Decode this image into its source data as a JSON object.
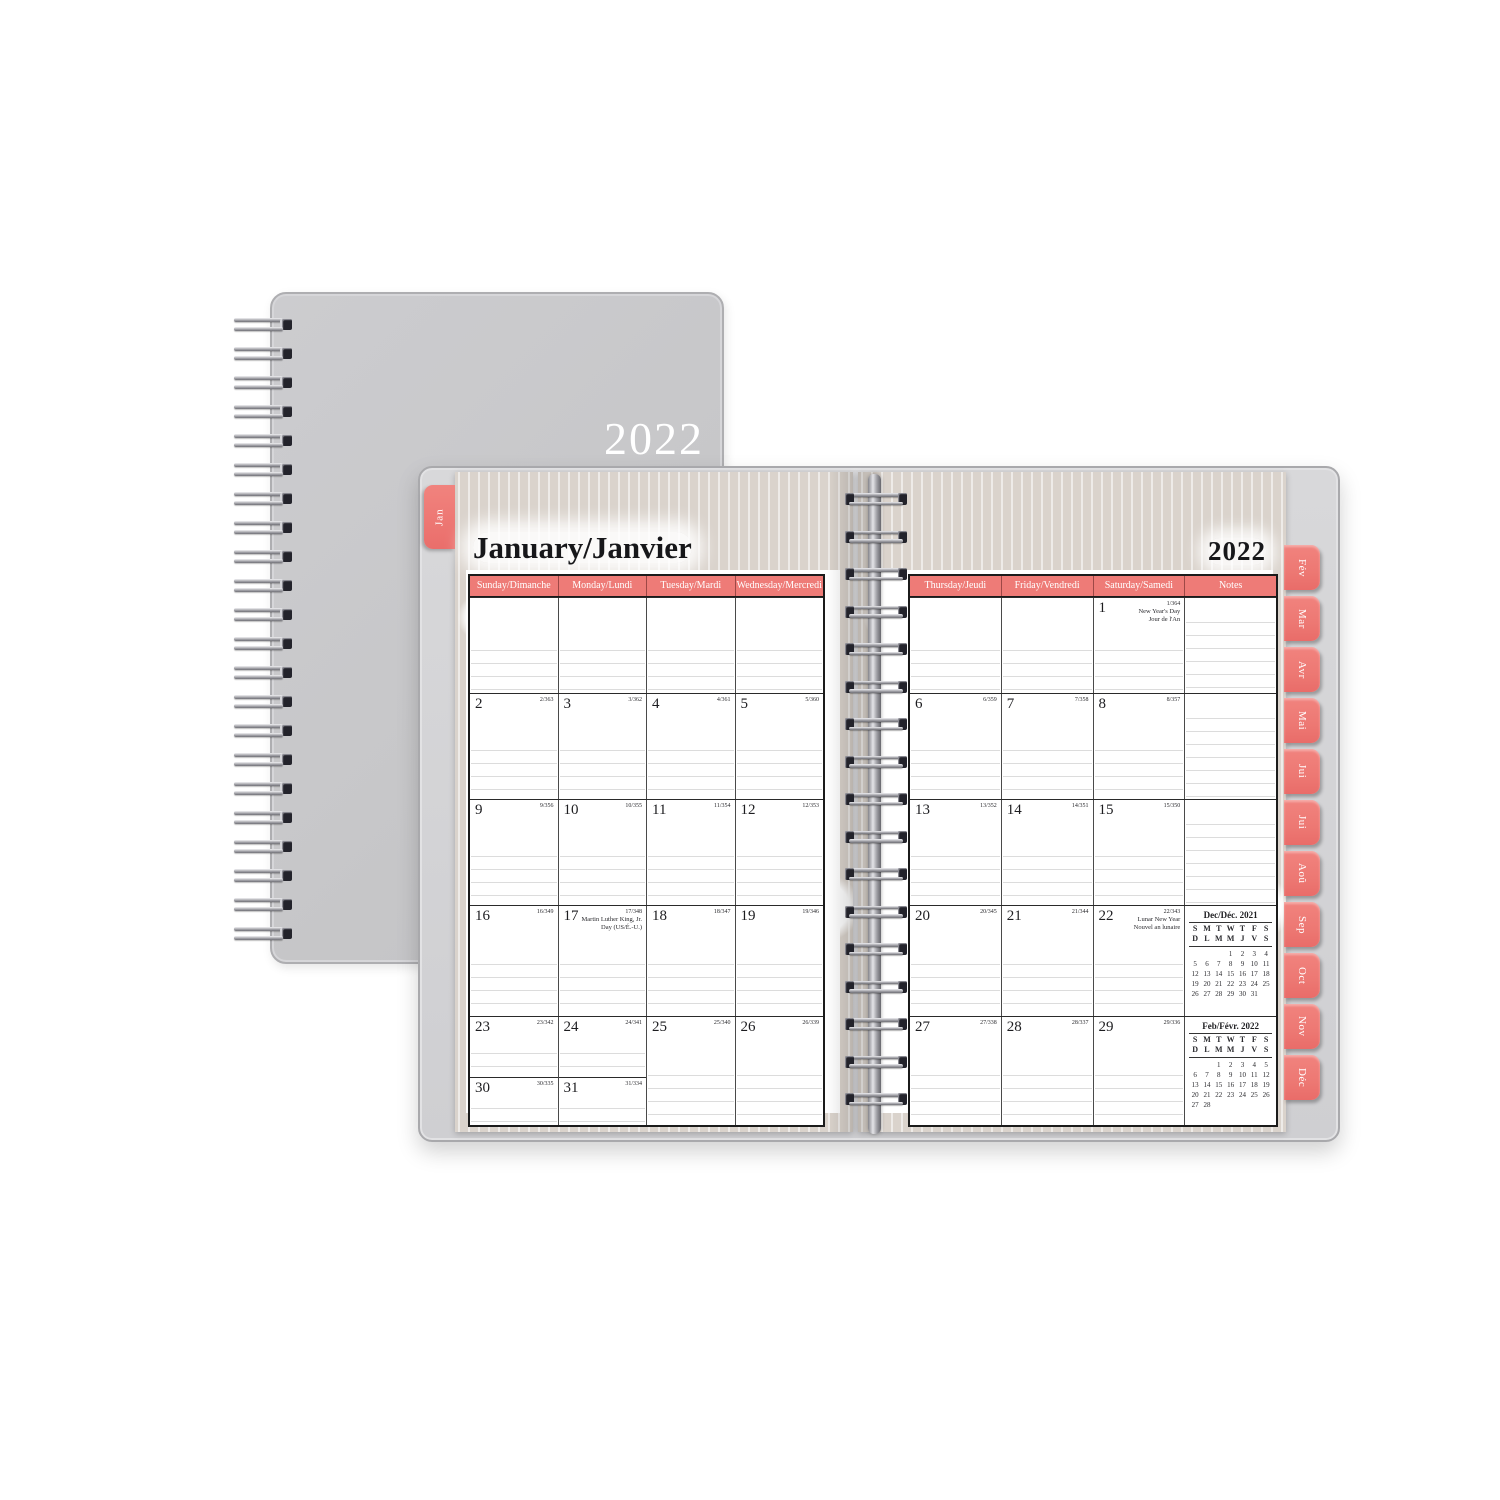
{
  "cover": {
    "year": "2022"
  },
  "planner": {
    "left_page": {
      "tab": "Jan",
      "title": "January/Janvier",
      "day_headers": [
        "Sunday/Dimanche",
        "Monday/Lundi",
        "Tuesday/Mardi",
        "Wednesday/Mercredi"
      ]
    },
    "right_page": {
      "year": "2022",
      "day_headers": [
        "Thursday/Jeudi",
        "Friday/Vendredi",
        "Saturday/Samedi",
        "Notes"
      ]
    },
    "month_tabs": [
      "Fév",
      "Mar",
      "Avr",
      "Mai",
      "Jui",
      "Jui",
      "Aoû",
      "Sep",
      "Oct",
      "Nov",
      "Déc"
    ],
    "colors": {
      "coral": "#ee7b77",
      "cover_gray": "#c8c8ca",
      "ikat_beige": "#dad3cc",
      "page_white": "#ffffff"
    }
  },
  "calendar": {
    "left_rows": [
      [
        {
          "type": "empty"
        },
        {
          "type": "empty"
        },
        {
          "type": "empty"
        },
        {
          "type": "empty"
        }
      ],
      [
        {
          "day": "2",
          "frac": "2/363"
        },
        {
          "day": "3",
          "frac": "3/362"
        },
        {
          "day": "4",
          "frac": "4/361"
        },
        {
          "day": "5",
          "frac": "5/360"
        }
      ],
      [
        {
          "day": "9",
          "frac": "9/356"
        },
        {
          "day": "10",
          "frac": "10/355"
        },
        {
          "day": "11",
          "frac": "11/354"
        },
        {
          "day": "12",
          "frac": "12/353"
        }
      ],
      [
        {
          "day": "16",
          "frac": "16/349"
        },
        {
          "day": "17",
          "frac": "17/348",
          "holiday": [
            "Martin Luther King, Jr.",
            "Day (US/É.-U.)"
          ]
        },
        {
          "day": "18",
          "frac": "18/347"
        },
        {
          "day": "19",
          "frac": "19/346"
        }
      ],
      [
        {
          "day": "23",
          "frac": "23/342",
          "split": {
            "day": "30",
            "frac": "30/335"
          }
        },
        {
          "day": "24",
          "frac": "24/341",
          "split": {
            "day": "31",
            "frac": "31/334"
          }
        },
        {
          "day": "25",
          "frac": "25/340"
        },
        {
          "day": "26",
          "frac": "26/339"
        }
      ]
    ],
    "right_rows": [
      [
        {
          "type": "empty"
        },
        {
          "type": "empty"
        },
        {
          "day": "1",
          "frac": "1/364",
          "holiday": [
            "New Year's Day",
            "Jour de l'An"
          ]
        },
        {
          "type": "notes"
        }
      ],
      [
        {
          "day": "6",
          "frac": "6/359"
        },
        {
          "day": "7",
          "frac": "7/358"
        },
        {
          "day": "8",
          "frac": "8/357"
        },
        {
          "type": "notes"
        }
      ],
      [
        {
          "day": "13",
          "frac": "13/352"
        },
        {
          "day": "14",
          "frac": "14/351"
        },
        {
          "day": "15",
          "frac": "15/350"
        },
        {
          "type": "notes"
        }
      ],
      [
        {
          "day": "20",
          "frac": "20/345"
        },
        {
          "day": "21",
          "frac": "21/344"
        },
        {
          "day": "22",
          "frac": "22/343",
          "holiday": [
            "Lunar New Year",
            "Nouvel an lunaire"
          ]
        },
        {
          "type": "notes",
          "minical": 0
        }
      ],
      [
        {
          "day": "27",
          "frac": "27/338"
        },
        {
          "day": "28",
          "frac": "28/337"
        },
        {
          "day": "29",
          "frac": "29/336"
        },
        {
          "type": "notes",
          "minical": 1
        }
      ]
    ],
    "mini_calendars": [
      {
        "title": "Dec/Déc. 2021",
        "dow_en": [
          "S",
          "M",
          "T",
          "W",
          "T",
          "F",
          "S"
        ],
        "dow_fr": [
          "D",
          "L",
          "M",
          "M",
          "J",
          "V",
          "S"
        ],
        "weeks": [
          [
            "",
            "",
            "",
            "1",
            "2",
            "3",
            "4"
          ],
          [
            "5",
            "6",
            "7",
            "8",
            "9",
            "10",
            "11"
          ],
          [
            "12",
            "13",
            "14",
            "15",
            "16",
            "17",
            "18"
          ],
          [
            "19",
            "20",
            "21",
            "22",
            "23",
            "24",
            "25"
          ],
          [
            "26",
            "27",
            "28",
            "29",
            "30",
            "31",
            ""
          ]
        ]
      },
      {
        "title": "Feb/Févr. 2022",
        "dow_en": [
          "S",
          "M",
          "T",
          "W",
          "T",
          "F",
          "S"
        ],
        "dow_fr": [
          "D",
          "L",
          "M",
          "M",
          "J",
          "V",
          "S"
        ],
        "weeks": [
          [
            "",
            "",
            "1",
            "2",
            "3",
            "4",
            "5"
          ],
          [
            "6",
            "7",
            "8",
            "9",
            "10",
            "11",
            "12"
          ],
          [
            "13",
            "14",
            "15",
            "16",
            "17",
            "18",
            "19"
          ],
          [
            "20",
            "21",
            "22",
            "23",
            "24",
            "25",
            "26"
          ],
          [
            "27",
            "28",
            "",
            "",
            "",
            "",
            ""
          ]
        ]
      }
    ]
  }
}
